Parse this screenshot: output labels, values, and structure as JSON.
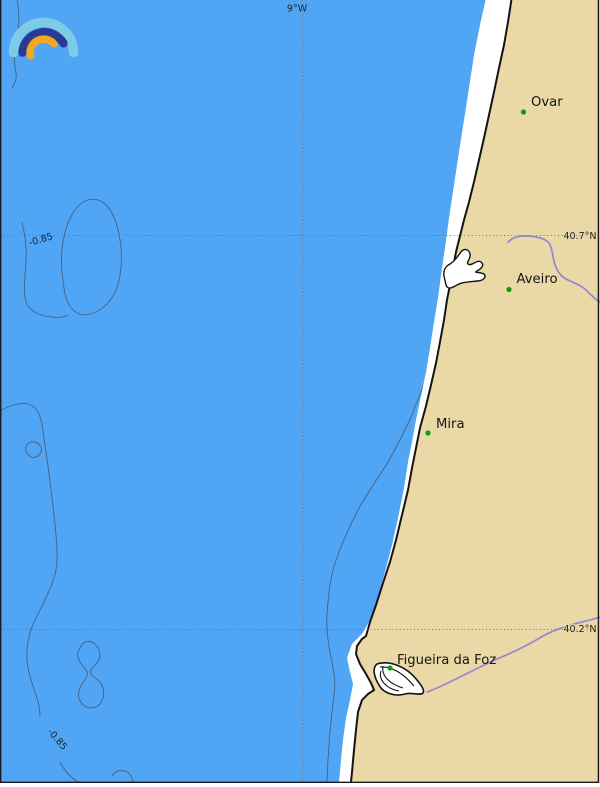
{
  "grid": {
    "meridian_label": "9°W",
    "parallel_labels": [
      "40.7°N",
      "40.2°N"
    ]
  },
  "cities": [
    {
      "name": "Ovar"
    },
    {
      "name": "Aveiro"
    },
    {
      "name": "Mira"
    },
    {
      "name": "Figueira da Foz"
    }
  ],
  "contour_labels": [
    "-0.85",
    "-0.85"
  ],
  "colors": {
    "ocean": "#50A5F4",
    "land": "#EAD9A6",
    "beach": "#FFFFFF",
    "coastline": "#141414",
    "river": "#9486D8",
    "contour": "#4A5568",
    "grid": "#6E6E6E",
    "city_marker": "#0D9D0D",
    "frame": "#1A1A1A",
    "logo_arc_outer": "#7ECBE8",
    "logo_arc_middle": "#2B3990",
    "logo_arc_inner": "#F5A623"
  },
  "logo": {
    "name": "three-arcs-logo"
  }
}
